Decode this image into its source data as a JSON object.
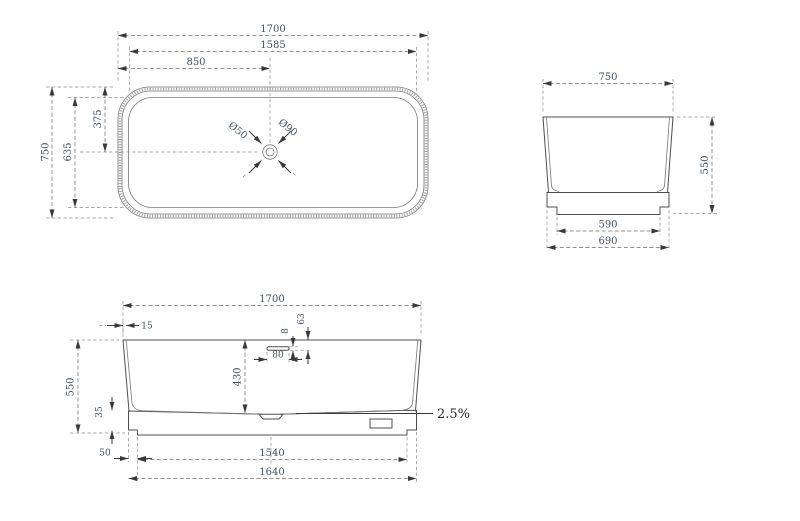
{
  "colors": {
    "background": "#ffffff",
    "geometry_line": "#4f4f4f",
    "dimension_line": "#6e6e6e",
    "dimension_text": "#42525f",
    "slope_text": "#1f1f1f"
  },
  "plan_view": {
    "dims": {
      "overall_length": "1700",
      "rim_length": "1585",
      "drain_offset_x": "850",
      "overall_width": "750",
      "rim_width": "635",
      "drain_offset_y": "375",
      "drain_hole": "Ø50",
      "drain_flange": "Ø90"
    }
  },
  "end_view": {
    "dims": {
      "overall_width": "750",
      "overall_height": "550",
      "base_bottom_width": "590",
      "base_top_width": "690"
    }
  },
  "side_view": {
    "dims": {
      "overall_length": "1700",
      "wall_thickness_top": "15",
      "overflow_depth": "63",
      "overflow_slot_height": "8",
      "overflow_slot_width": "80",
      "inner_depth": "430",
      "overall_height": "550",
      "base_height": "35",
      "base_step": "50",
      "base_bottom_length": "1540",
      "base_top_length": "1640",
      "floor_slope": "2.5%"
    }
  }
}
